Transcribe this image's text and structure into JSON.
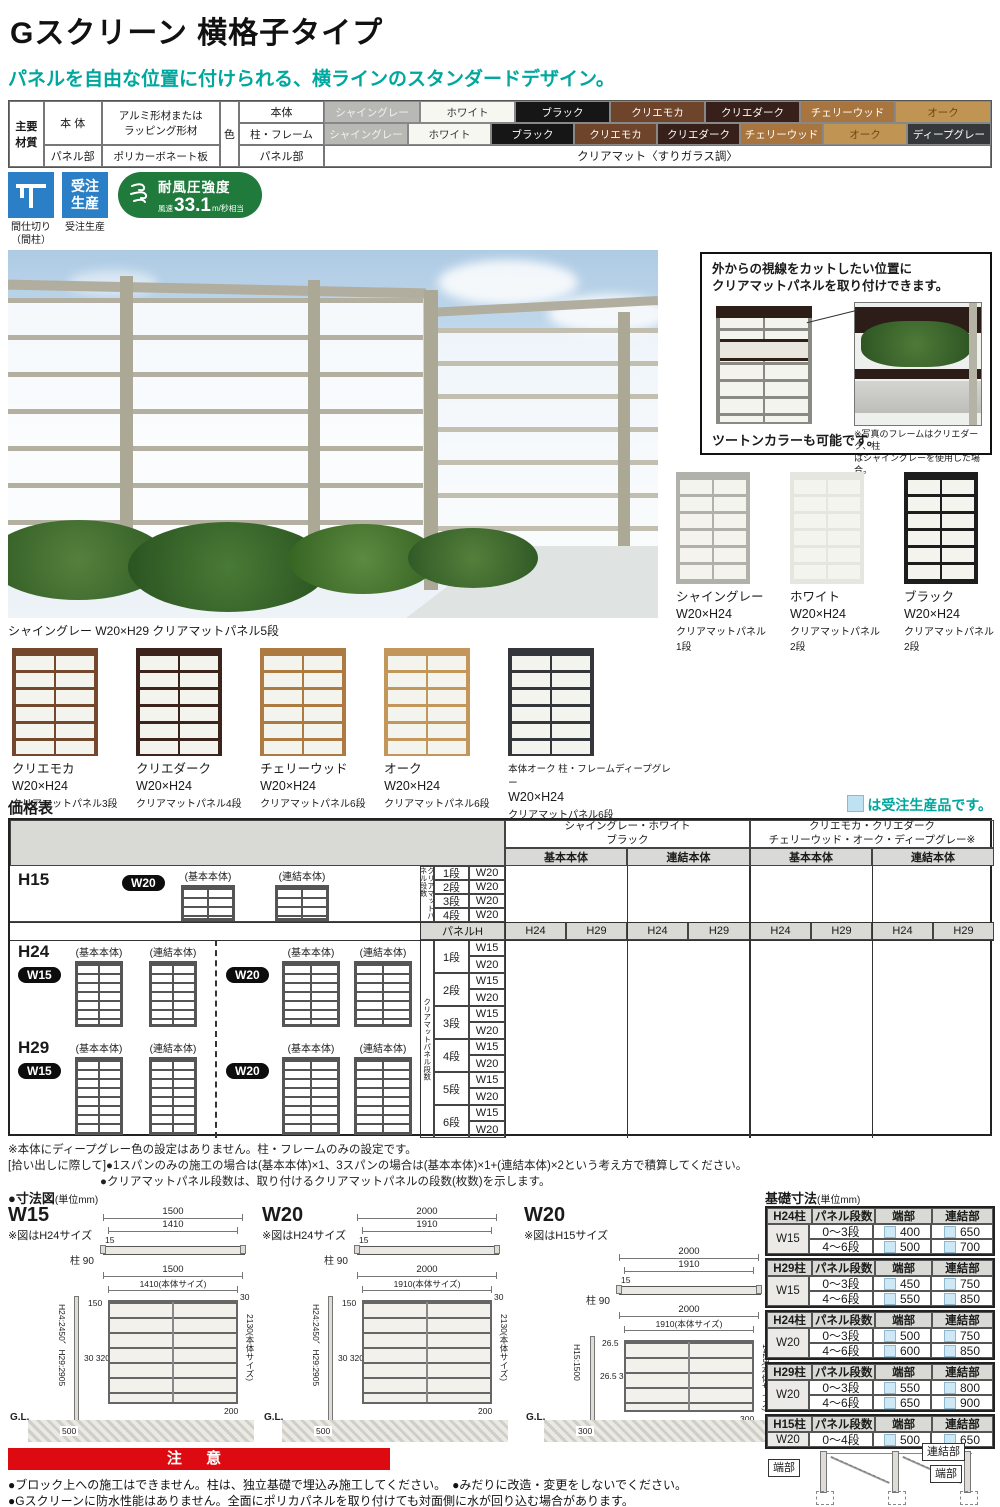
{
  "header": {
    "title": "Gスクリーン 横格子タイプ",
    "subtitle": "パネルを自由な位置に付けられる、横ラインのスタンダードデザイン。"
  },
  "materials": {
    "corner_label": "主要\n材質",
    "body_label": "本 体",
    "body_desc": "アルミ形材または\nラッピング形材",
    "panel_label": "パネル部",
    "panel_desc": "ポリカーボネート板",
    "color_label": "色",
    "row1_label": "本体",
    "row2_label": "柱・フレーム",
    "row3_label": "パネル部",
    "row3_value": "クリアマット〈すりガラス調〉",
    "row1": [
      {
        "label": "シャイングレー",
        "bg": "#b8b8b4",
        "fg": "#f2f2f0"
      },
      {
        "label": "ホワイト",
        "bg": "#f7f7f1",
        "fg": "#333333"
      },
      {
        "label": "ブラック",
        "bg": "#161616",
        "fg": "#ffffff"
      },
      {
        "label": "クリエモカ",
        "bg": "#6e442a",
        "fg": "#ffffff"
      },
      {
        "label": "クリエダーク",
        "bg": "#362019",
        "fg": "#ffffff"
      },
      {
        "label": "チェリーウッド",
        "bg": "#a9753f",
        "fg": "#ffffff"
      },
      {
        "label": "オーク",
        "bg": "#c09452",
        "fg": "#6e4413"
      }
    ],
    "row2": [
      {
        "label": "シャイングレー",
        "bg": "#b8b8b4",
        "fg": "#f2f2f0"
      },
      {
        "label": "ホワイト",
        "bg": "#f7f7f1",
        "fg": "#333333"
      },
      {
        "label": "ブラック",
        "bg": "#161616",
        "fg": "#ffffff"
      },
      {
        "label": "クリエモカ",
        "bg": "#6e442a",
        "fg": "#ffffff"
      },
      {
        "label": "クリエダーク",
        "bg": "#362019",
        "fg": "#ffffff"
      },
      {
        "label": "チェリーウッド",
        "bg": "#a9753f",
        "fg": "#ffffff"
      },
      {
        "label": "オーク",
        "bg": "#c09452",
        "fg": "#6e4413"
      },
      {
        "label": "ディープグレー",
        "bg": "#35383b",
        "fg": "#ffffff"
      }
    ]
  },
  "badges": {
    "partition_label": "間仕切り\n（間柱）",
    "order_text": "受注\n生産",
    "order_label": "受注生産",
    "wind_title": "耐風圧強度",
    "wind_prefix": "風速",
    "wind_value": "33.1",
    "wind_unit": "m/秒",
    "wind_suffix": "相当"
  },
  "photo": {
    "caption": "シャイングレー W20×H29 クリアマットパネル5段"
  },
  "info_box": {
    "headline": "外からの視線をカットしたい位置に\nクリアマットパネルを取り付けできます。",
    "two_tone": "ツートンカラーも可能です。",
    "note": "※写真のフレームはクリエダーク、柱\nはシャイングレーを使用した場合。"
  },
  "variants_row1": [
    {
      "name": "シャイングレー",
      "size": "W20×H24",
      "panels": "クリアマットパネル1段",
      "frame": "#b1b1ac"
    },
    {
      "name": "ホワイト",
      "size": "W20×H24",
      "panels": "クリアマットパネル2段",
      "frame": "#e6e6e0"
    },
    {
      "name": "ブラック",
      "size": "W20×H24",
      "panels": "クリアマットパネル2段",
      "frame": "#1d1d1d"
    }
  ],
  "variants_row2": [
    {
      "name": "クリエモカ",
      "size": "W20×H24",
      "panels": "クリアマットパネル3段",
      "frame": "#74482c"
    },
    {
      "name": "クリエダーク",
      "size": "W20×H24",
      "panels": "クリアマットパネル4段",
      "frame": "#3c241c"
    },
    {
      "name": "チェリーウッド",
      "size": "W20×H24",
      "panels": "クリアマットパネル6段",
      "frame": "#ad7a42"
    },
    {
      "name": "オーク",
      "size": "W20×H24",
      "panels": "クリアマットパネル6段",
      "frame": "#c3975c"
    },
    {
      "name": "本体オーク 柱・フレームディープグレー",
      "size": "W20×H24",
      "panels": "クリアマットパネル6段",
      "frame": "#33363a"
    }
  ],
  "price": {
    "title": "価格表",
    "legend_text": "は受注生産品です。",
    "groups": [
      {
        "line1": "シャイングレー・ホワイト",
        "line2": "ブラック",
        "sub1": "基本本体",
        "sub2": "連結本体"
      },
      {
        "line1": "クリエモカ・クリエダーク",
        "line2": "チェリーウッド・オーク・ディープグレー※",
        "sub1": "基本本体",
        "sub2": "連結本体"
      }
    ],
    "h15_label": "H15",
    "h15_badge": "W20",
    "basic": "(基本本体)",
    "joint": "(連結本体)",
    "h15_rot": "クリアマットパネル段数",
    "h15_rows": [
      {
        "dan": "1段",
        "w": "W20"
      },
      {
        "dan": "2段",
        "w": "W20"
      },
      {
        "dan": "3段",
        "w": "W20"
      },
      {
        "dan": "4段",
        "w": "W20"
      }
    ],
    "panel_h": "パネルH",
    "panel_h_cols": [
      "H24",
      "H29",
      "H24",
      "H29",
      "H24",
      "H29",
      "H24",
      "H29"
    ],
    "h24_label": "H24",
    "h24_w15": "W15",
    "h24_w20": "W20",
    "h29_label": "H29",
    "h29_w15": "W15",
    "h29_w20": "W20",
    "rot_label": "クリアマットパネル段数",
    "dan_rows": [
      {
        "dan": "1段",
        "s1": "W15",
        "s2": "W20"
      },
      {
        "dan": "2段",
        "s1": "W15",
        "s2": "W20"
      },
      {
        "dan": "3段",
        "s1": "W15",
        "s2": "W20"
      },
      {
        "dan": "4段",
        "s1": "W15",
        "s2": "W20"
      },
      {
        "dan": "5段",
        "s1": "W15",
        "s2": "W20"
      },
      {
        "dan": "6段",
        "s1": "W15",
        "s2": "W20"
      }
    ]
  },
  "notes": {
    "line1": "※本体にディープグレー色の設定はありません。柱・フレームのみの設定です。",
    "line2": "[拾い出しに際して]●1スパンのみの施工の場合は(基本本体)×1、3スパンの場合は(基本本体)×1+(連結本体)×2という考え方で積算してください。",
    "line3": "●クリアマットパネル段数は、取り付けるクリアマットパネルの段数(枚数)を示します。"
  },
  "dims": {
    "title": "●寸法図",
    "unit": "(単位mm)",
    "diagrams": [
      {
        "name": "W15",
        "note": "※図はH24サイズ",
        "top_total": "1500",
        "top_body": "1410",
        "top_t": "15",
        "post": "柱 90",
        "f_total": "1500",
        "f_body": "1410(本体サイズ)",
        "topgap": "150",
        "beam": "30",
        "height": "H24:2450、H29:2905",
        "bodyh": "2130(本体サイズ)",
        "rails": "30\n320\n30",
        "bottom": "200",
        "gl": "G.L.",
        "embed": "500"
      },
      {
        "name": "W20",
        "note": "※図はH24サイズ",
        "top_total": "2000",
        "top_body": "1910",
        "top_t": "15",
        "post": "柱 90",
        "f_total": "2000",
        "f_body": "1910(本体サイズ)",
        "topgap": "150",
        "beam": "30",
        "height": "H24:2450、H29:2905",
        "bodyh": "2130(本体サイズ)",
        "rails": "30\n320\n30",
        "bottom": "200",
        "gl": "G.L.",
        "embed": "500"
      },
      {
        "name": "W20",
        "note": "※図はH15サイズ",
        "top_total": "2000",
        "top_body": "1910",
        "top_t": "15",
        "post": "柱 90",
        "f_total": "2000",
        "f_body": "1910(本体サイズ)",
        "topgap": "26.5",
        "beam": "30",
        "height": "H15:1500",
        "bodyh": "1423(本体サイズ)",
        "rails": "26.5\n320\n30",
        "bottom": "300",
        "gl": "G.L.",
        "embed": "300"
      }
    ]
  },
  "foundation": {
    "title": "基礎寸法",
    "unit": "(単位mm)",
    "col2": "パネル段数",
    "col3": "端部",
    "col4": "連結部",
    "tables": [
      {
        "post": "H24柱",
        "width": "W15",
        "rows": [
          {
            "dan": "0〜3段",
            "a": "400",
            "b": "650"
          },
          {
            "dan": "4〜6段",
            "a": "500",
            "b": "700"
          }
        ]
      },
      {
        "post": "H29柱",
        "width": "W15",
        "rows": [
          {
            "dan": "0〜3段",
            "a": "450",
            "b": "750"
          },
          {
            "dan": "4〜6段",
            "a": "550",
            "b": "850"
          }
        ]
      },
      {
        "post": "H24柱",
        "width": "W20",
        "rows": [
          {
            "dan": "0〜3段",
            "a": "500",
            "b": "750"
          },
          {
            "dan": "4〜6段",
            "a": "600",
            "b": "850"
          }
        ]
      },
      {
        "post": "H29柱",
        "width": "W20",
        "rows": [
          {
            "dan": "0〜3段",
            "a": "550",
            "b": "800"
          },
          {
            "dan": "4〜6段",
            "a": "650",
            "b": "900"
          }
        ]
      },
      {
        "post": "H15柱",
        "width": "W20",
        "rows": [
          {
            "dan": "0〜4段",
            "a": "500",
            "b": "650"
          }
        ]
      }
    ],
    "lbl_left": "端部",
    "lbl_right1": "連結部",
    "lbl_right2": "端部"
  },
  "caution": {
    "banner": "注 意",
    "line1": "●ブロック上への施工はできません。柱は、独立基礎で埋込み施工してください。　●みだりに改造・変更をしないでください。",
    "line2": "●Gスクリーンに防水性能はありません。全面にポリカパネルを取り付けても対面側に水が回り込む場合があります。"
  }
}
